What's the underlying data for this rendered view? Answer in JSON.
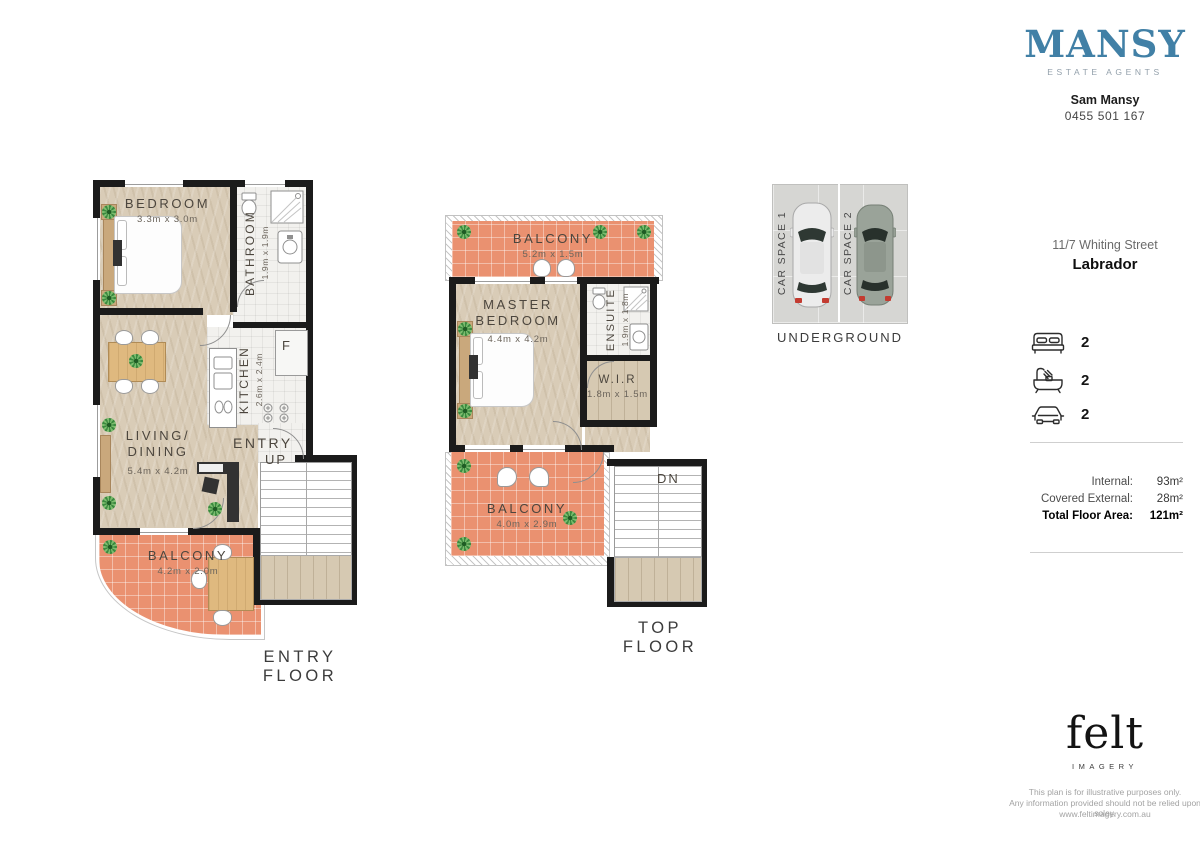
{
  "brand": {
    "logo_text": "MANSY",
    "logo_tagline": "ESTATE AGENTS",
    "logo_color": "#4180a6",
    "agent_name": "Sam Mansy",
    "agent_phone": "0455 501 167"
  },
  "property": {
    "address_line1": "11/7 Whiting Street",
    "address_line2": "Labrador",
    "features": {
      "beds": "2",
      "baths": "2",
      "cars": "2"
    },
    "areas": {
      "internal_label": "Internal:",
      "internal_value": "93m²",
      "external_label": "Covered External:",
      "external_value": "28m²",
      "total_label": "Total Floor Area:",
      "total_value": "121m²"
    }
  },
  "entry_floor": {
    "caption": "ENTRY FLOOR",
    "bedroom_name": "BEDROOM",
    "bedroom_dims": "3.3m x 3.0m",
    "bathroom_name": "BATHROOM",
    "bathroom_dims": "1.9m x 1.9m",
    "kitchen_name": "KITCHEN",
    "kitchen_dims": "2.6m x 2.4m",
    "living_name1": "LIVING/",
    "living_name2": "DINING",
    "living_dims": "5.4m x 4.2m",
    "balcony_name": "BALCONY",
    "balcony_dims": "4.2m x 2.0m",
    "entry_label": "ENTRY",
    "up_label": "UP",
    "fridge_label": "F"
  },
  "top_floor": {
    "caption": "TOP FLOOR",
    "balcony1_name": "BALCONY",
    "balcony1_dims": "5.2m x 1.5m",
    "master_name1": "MASTER",
    "master_name2": "BEDROOM",
    "master_dims": "4.4m x 4.2m",
    "ensuite_name": "ENSUITE",
    "ensuite_dims": "1.9m x 1.8m",
    "wir_name": "W.I.R",
    "wir_dims": "1.8m x 1.5m",
    "balcony2_name": "BALCONY",
    "balcony2_dims": "4.0m x 2.9m",
    "dn_label": "DN"
  },
  "underground": {
    "caption": "UNDERGROUND",
    "space1": "CAR SPACE 1",
    "space2": "CAR SPACE 2"
  },
  "imagery": {
    "logo_text": "felt",
    "logo_sub": "IMAGERY",
    "disclaimer_line1": "This plan is for illustrative purposes only.",
    "disclaimer_line2": "Any information provided should not be relied upon soley.",
    "website": "www.feltimagery.com.au"
  },
  "palette": {
    "wall": "#1b1b1b",
    "floor_timber": "#d9ccb7",
    "balcony_tile": "#ea9170",
    "wet_area_tile": "#f2f1ee"
  }
}
